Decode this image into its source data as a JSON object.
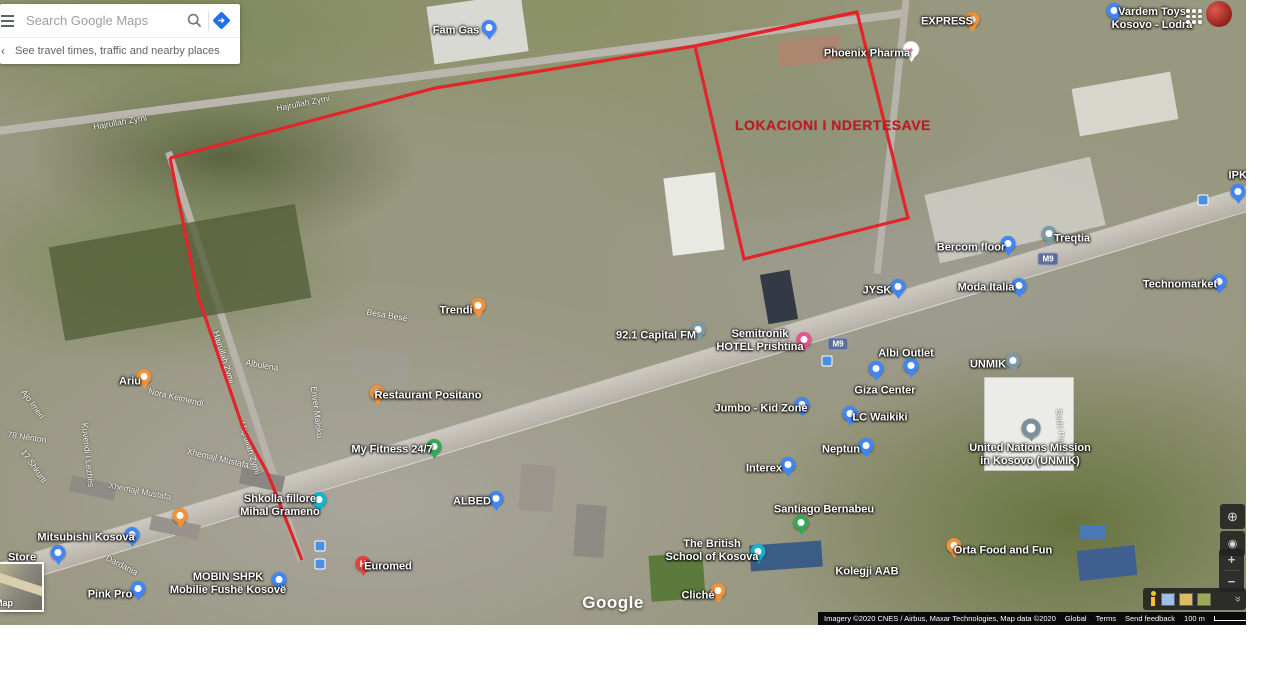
{
  "search": {
    "placeholder": "Search Google Maps",
    "hint": "See travel times, traffic and nearby places"
  },
  "watermark": "Google",
  "overlay": {
    "color": "#e3242b",
    "title": "LOKACIONI I NDERTESAVE",
    "title_color": "#c61622",
    "polylines": [
      {
        "name": "site-left-boundary",
        "points": [
          [
            170,
            158
          ],
          [
            198,
            296
          ],
          [
            243,
            428
          ],
          [
            268,
            474
          ],
          [
            302,
            560
          ]
        ]
      },
      {
        "name": "site-top-boundary",
        "points": [
          [
            170,
            158
          ],
          [
            435,
            88
          ],
          [
            695,
            46
          ],
          [
            857,
            12
          ]
        ]
      },
      {
        "name": "building-parcel-outline",
        "points": [
          [
            695,
            46
          ],
          [
            857,
            12
          ],
          [
            908,
            218
          ],
          [
            744,
            259
          ],
          [
            695,
            46
          ]
        ]
      }
    ]
  },
  "map": {
    "places": [
      {
        "label": "Fam Gas",
        "x": 456,
        "y": 31,
        "pin": {
          "type": "blue",
          "x": 489,
          "y": 29
        }
      },
      {
        "label": "EXPRESS",
        "x": 947,
        "y": 22,
        "pin": {
          "type": "orange",
          "x": 972,
          "y": 21
        }
      },
      {
        "label": "Phoenix Pharma",
        "x": 867,
        "y": 54,
        "pin": {
          "type": "pharma",
          "x": 911,
          "y": 51
        }
      },
      {
        "lines": [
          "Vardem Toys",
          "Kosovo - Lodra"
        ],
        "x": 1152,
        "y": 19,
        "pin": {
          "type": "blue",
          "x": 1114,
          "y": 12
        }
      },
      {
        "label": "IPKO",
        "x": 1242,
        "y": 176,
        "pin": {
          "type": "blue",
          "x": 1238,
          "y": 193
        }
      },
      {
        "label": "Treqtia",
        "x": 1072,
        "y": 239,
        "pin": {
          "type": "grey",
          "x": 1049,
          "y": 235
        }
      },
      {
        "label": "Bercom floor",
        "x": 971,
        "y": 248,
        "pin": {
          "type": "blue",
          "x": 1008,
          "y": 245
        }
      },
      {
        "label": "Moda Italia",
        "x": 986,
        "y": 288,
        "pin": {
          "type": "blue",
          "x": 1019,
          "y": 287
        }
      },
      {
        "label": "Technomarket",
        "x": 1180,
        "y": 285,
        "pin": {
          "type": "blue",
          "x": 1219,
          "y": 283
        }
      },
      {
        "label": "JYSK",
        "x": 877,
        "y": 291,
        "pin": {
          "type": "blue",
          "x": 898,
          "y": 288
        }
      },
      {
        "label": "92.1 Capital FM",
        "x": 656,
        "y": 336,
        "pin": {
          "type": "grey",
          "x": 698,
          "y": 331
        }
      },
      {
        "lines": [
          "Semitronik",
          "HOTEL Prishtina"
        ],
        "x": 760,
        "y": 341,
        "pin": {
          "type": "pink",
          "x": 804,
          "y": 341
        }
      },
      {
        "label": "Albi Outlet",
        "x": 906,
        "y": 354,
        "pin": {
          "type": "blue",
          "x": 911,
          "y": 367
        }
      },
      {
        "label": "UNMIK",
        "x": 988,
        "y": 365,
        "pin": {
          "type": "grey",
          "x": 1013,
          "y": 362
        }
      },
      {
        "label": "Giza Center",
        "x": 885,
        "y": 391,
        "pin": {
          "type": "blue",
          "x": 876,
          "y": 370
        }
      },
      {
        "label": "LC Waikiki",
        "x": 880,
        "y": 418,
        "pin": {
          "type": "blue",
          "x": 850,
          "y": 415
        }
      },
      {
        "label": "Neptun",
        "x": 841,
        "y": 450,
        "pin": {
          "type": "blue",
          "x": 866,
          "y": 447
        }
      },
      {
        "lines": [
          "United Nations Mission",
          "in Kosovo (UNMIK)"
        ],
        "x": 1030,
        "y": 455,
        "pin": {
          "type": "gov",
          "x": 1031,
          "y": 430
        }
      },
      {
        "label": "Jumbo - Kid Zone",
        "x": 761,
        "y": 409,
        "pin": {
          "type": "blue",
          "x": 802,
          "y": 406
        }
      },
      {
        "label": "Interex",
        "x": 764,
        "y": 469,
        "pin": {
          "type": "blue",
          "x": 788,
          "y": 466
        }
      },
      {
        "label": "Ariu",
        "x": 130,
        "y": 382,
        "pin": {
          "type": "orange",
          "x": 144,
          "y": 378
        }
      },
      {
        "label": "Trendi",
        "x": 456,
        "y": 311,
        "pin": {
          "type": "orange",
          "x": 478,
          "y": 307
        }
      },
      {
        "label": "Restaurant Positano",
        "x": 428,
        "y": 396,
        "pin": {
          "type": "orange",
          "x": 377,
          "y": 394
        }
      },
      {
        "label": "My Fitness 24/7",
        "x": 392,
        "y": 450,
        "pin": {
          "type": "green",
          "x": 434,
          "y": 448
        }
      },
      {
        "lines": [
          "Shkolla fillore",
          "Mihal Grameno"
        ],
        "x": 280,
        "y": 506,
        "pin": {
          "type": "teal",
          "x": 319,
          "y": 501
        }
      },
      {
        "label": "ALBED",
        "x": 472,
        "y": 502,
        "pin": {
          "type": "blue",
          "x": 496,
          "y": 500
        }
      },
      {
        "label": "Mitsubishi Kosova",
        "x": 86,
        "y": 538,
        "pin": {
          "type": "blue",
          "x": 132,
          "y": 536
        }
      },
      {
        "label": "Store",
        "x": 22,
        "y": 558,
        "pin": {
          "type": "blue",
          "x": 58,
          "y": 554
        }
      },
      {
        "label": "Pink Pro",
        "x": 110,
        "y": 595,
        "pin": {
          "type": "blue",
          "x": 138,
          "y": 590
        }
      },
      {
        "lines": [
          "MOBIN SHPK",
          "Mobilie Fushë Kosovë"
        ],
        "x": 228,
        "y": 584,
        "pin": {
          "type": "blue",
          "x": 279,
          "y": 581
        }
      },
      {
        "label": "Euromed",
        "x": 388,
        "y": 567,
        "pin": {
          "type": "red",
          "x": 363,
          "y": 565
        }
      },
      {
        "label": "Santiago Bernabeu",
        "x": 824,
        "y": 510,
        "pin": {
          "type": "green",
          "x": 801,
          "y": 524
        }
      },
      {
        "label": "Kolegji AAB",
        "x": 867,
        "y": 572
      },
      {
        "label": "Orta Food and Fun",
        "x": 1003,
        "y": 551,
        "pin": {
          "type": "orange",
          "x": 954,
          "y": 547
        }
      },
      {
        "lines": [
          "The British",
          "School of Kosova"
        ],
        "x": 712,
        "y": 551,
        "pin": {
          "type": "teal",
          "x": 758,
          "y": 553
        }
      },
      {
        "label": "Cliché",
        "x": 698,
        "y": 596,
        "pin": {
          "type": "orange",
          "x": 718,
          "y": 592
        }
      },
      {
        "name": "unlabeled-restaurant",
        "x": 180,
        "y": 517,
        "pin": {
          "type": "orange",
          "x": 180,
          "y": 517
        }
      }
    ],
    "streets": [
      {
        "name": "Hajrullah Zymi",
        "x": 120,
        "y": 122,
        "rot": -10
      },
      {
        "name": "Hajrullah Zymi",
        "x": 303,
        "y": 103,
        "rot": -11
      },
      {
        "name": "Hajrullah Zymi",
        "x": 224,
        "y": 357,
        "rot": 73
      },
      {
        "name": "Hajrullah Zymi",
        "x": 250,
        "y": 448,
        "rot": 73
      },
      {
        "name": "Nora Kelmendi",
        "x": 176,
        "y": 397,
        "rot": 13
      },
      {
        "name": "Albulena",
        "x": 262,
        "y": 365,
        "rot": 10
      },
      {
        "name": "Enver Maloku",
        "x": 317,
        "y": 412,
        "rot": 83
      },
      {
        "name": "Besa Besë",
        "x": 387,
        "y": 315,
        "rot": 9
      },
      {
        "name": "Xhemajl Mustafa",
        "x": 218,
        "y": 458,
        "rot": 13
      },
      {
        "name": "Xhemajl Mustafa",
        "x": 140,
        "y": 491,
        "rot": 11
      },
      {
        "name": "Ajo Imeri",
        "x": 33,
        "y": 404,
        "rot": 55
      },
      {
        "name": "78 Nëntori",
        "x": 27,
        "y": 437,
        "rot": 8
      },
      {
        "name": "17 Shkurti",
        "x": 34,
        "y": 466,
        "rot": 55
      },
      {
        "name": "Kuvendi i Lezhës",
        "x": 88,
        "y": 455,
        "rot": 84
      },
      {
        "name": "Dardania",
        "x": 122,
        "y": 565,
        "rot": 27
      },
      {
        "name": "Bedri Pejani",
        "x": 1061,
        "y": 432,
        "rot": 85
      }
    ],
    "shields": [
      {
        "label": "M9",
        "x": 1048,
        "y": 259
      },
      {
        "label": "M9",
        "x": 838,
        "y": 344
      }
    ],
    "transit": [
      {
        "x": 1203,
        "y": 200
      },
      {
        "x": 827,
        "y": 361
      },
      {
        "x": 320,
        "y": 546
      },
      {
        "x": 320,
        "y": 564
      }
    ],
    "pin_colors": {
      "blue": "#4285f4",
      "orange": "#f0923a",
      "green": "#34a853",
      "pink": "#e8538f",
      "teal": "#12b5cb",
      "grey": "#7d99a5",
      "gov": "#7d8f9b",
      "red": "#e04438",
      "pharma": "#ffffff"
    }
  },
  "controls": {
    "zoom_in": "+",
    "zoom_out": "−",
    "collapse": "«",
    "globe": "⊕",
    "my_location": "◉",
    "directions_arrow": "➔",
    "hint_caret": "‹"
  },
  "inset": {
    "label": "Map"
  },
  "attribution": {
    "imagery": "Imagery ©2020 CNES / Airbus, Maxar Technologies, Map data ©2020",
    "links": [
      "Global",
      "Terms",
      "Send feedback"
    ],
    "scale": "100 m"
  }
}
